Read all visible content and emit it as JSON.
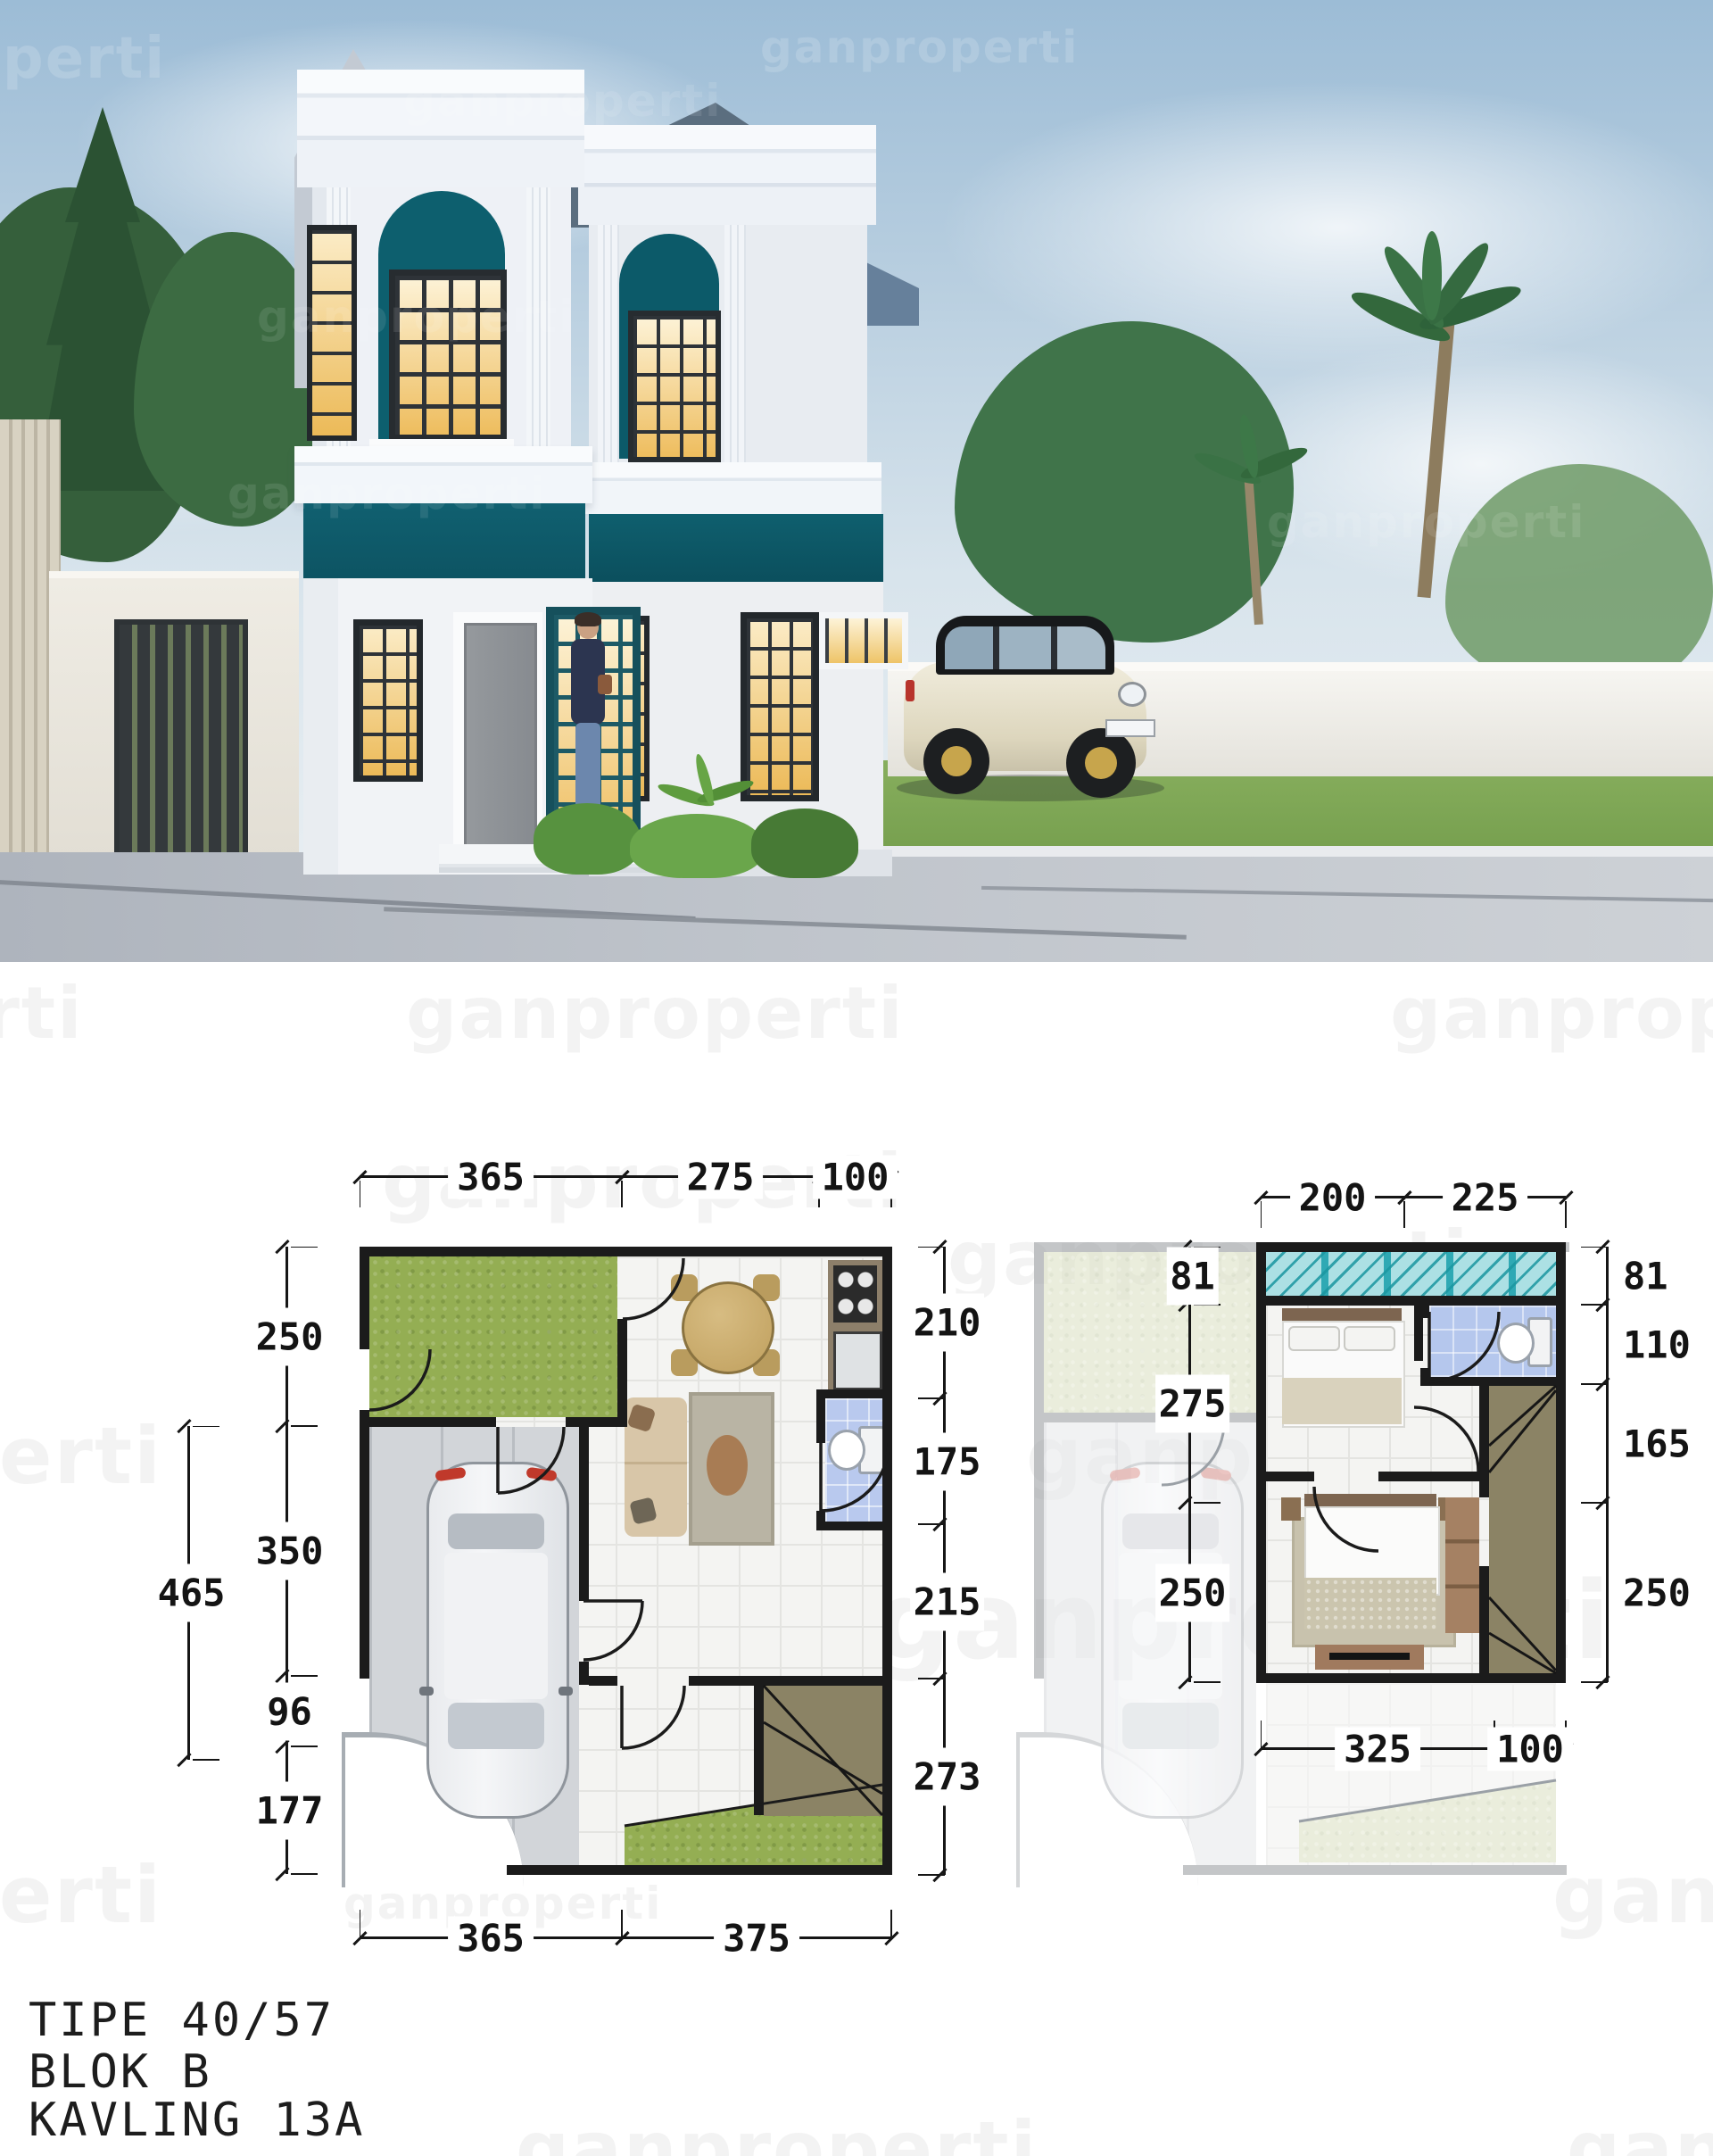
{
  "watermark": {
    "text": "ganproperti"
  },
  "caption": {
    "line1": "TIPE 40/57",
    "line2": "BLOK B",
    "line3": "KAVLING 13A"
  },
  "plans": {
    "left": {
      "top": [
        "365",
        "275",
        "100"
      ],
      "left": [
        "250",
        "350",
        "96",
        "177"
      ],
      "left_outer": "465",
      "right": [
        "210",
        "175",
        "215",
        "273"
      ],
      "bottom": [
        "365",
        "375"
      ]
    },
    "right": {
      "top": [
        "200",
        "225"
      ],
      "left": [
        "81",
        "275",
        "250"
      ],
      "right": [
        "81",
        "110",
        "165",
        "250"
      ],
      "bottom": [
        "325",
        "100"
      ]
    }
  }
}
